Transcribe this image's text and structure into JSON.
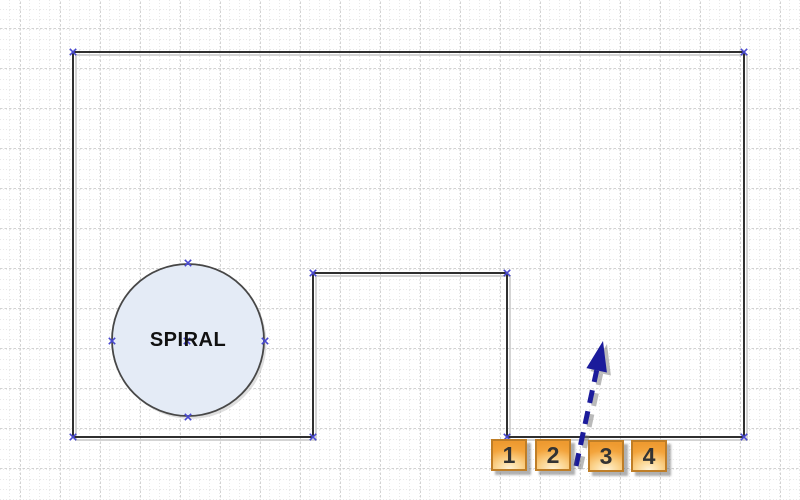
{
  "canvas": {
    "width_px": 800,
    "height_px": 500,
    "background_color": "#ffffff"
  },
  "grid": {
    "style": "dotted",
    "minor_spacing_px": 10,
    "major_spacing_px": 40,
    "minor_color": "#e9e9e9",
    "major_color": "#d2d2d2"
  },
  "shapes": {
    "wall_outline": {
      "type": "polygon",
      "stroke_color": "#2f2f2f",
      "fill": "none",
      "vertices": [
        [
          73,
          52
        ],
        [
          744,
          52
        ],
        [
          744,
          437
        ],
        [
          507,
          437
        ],
        [
          507,
          273
        ],
        [
          313,
          273
        ],
        [
          313,
          437
        ],
        [
          73,
          437
        ]
      ]
    },
    "spiral_circle": {
      "type": "circle",
      "label": "SPIRAL",
      "center": [
        188,
        340
      ],
      "radius": 76,
      "fill_color": "#e4ebf6",
      "stroke_color": "#474747",
      "label_color": "#111111"
    },
    "arrow": {
      "type": "dashed-arrow",
      "color": "#1b1b9b",
      "from": [
        576,
        466
      ],
      "to": [
        603,
        341
      ],
      "dash_pattern": "13 8.5"
    },
    "numbered_boxes": {
      "border_color": "#bf7e27",
      "fill_top_color": "#f3a43c",
      "fill_bottom_color": "#fff3d8",
      "text_color": "#333333",
      "items": [
        {
          "label": "1"
        },
        {
          "label": "2"
        },
        {
          "label": "3"
        },
        {
          "label": "4"
        }
      ]
    }
  },
  "handles": {
    "shape": "x-mark",
    "color": "#4848d0",
    "polygon_points": [
      [
        73,
        52
      ],
      [
        744,
        52
      ],
      [
        744,
        437
      ],
      [
        507,
        437
      ],
      [
        313,
        437
      ],
      [
        313,
        273
      ],
      [
        507,
        273
      ],
      [
        73,
        437
      ]
    ],
    "circle_points": [
      [
        188,
        263
      ],
      [
        188,
        417
      ],
      [
        112,
        341
      ],
      [
        265,
        341
      ],
      [
        187,
        341
      ]
    ]
  }
}
